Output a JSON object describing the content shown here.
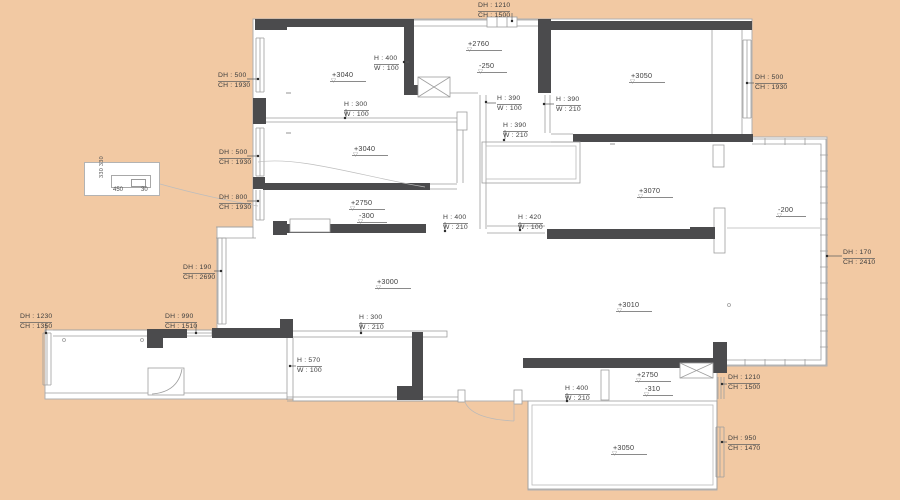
{
  "colors": {
    "background": "#f2c9a3",
    "floor": "#ffffff",
    "wall": "#4b4b4d",
    "line": "#9e9e9e",
    "thin": "#b9b9b9",
    "text": "#3e3e3e",
    "leader": "#5f5f5f"
  },
  "icons": {
    "level_triangle": "▽"
  },
  "dims": [
    {
      "l1": "DH : 500",
      "l2": "CH : 1930"
    },
    {
      "l1": "DH : 500",
      "l2": "CH : 1930"
    },
    {
      "l1": "DH : 800",
      "l2": "CH : 1930"
    },
    {
      "l1": "DH : 190",
      "l2": "CH : 2690"
    },
    {
      "l1": "DH : 1230",
      "l2": "CH : 1350"
    },
    {
      "l1": "DH : 990",
      "l2": "CH : 1510"
    },
    {
      "l1": "DH : 1210",
      "l2": "CH : 1500"
    },
    {
      "l1": "DH : 500",
      "l2": "CH : 1930"
    },
    {
      "l1": "DH : 170",
      "l2": "CH : 2410"
    },
    {
      "l1": "DH : 1210",
      "l2": "CH : 1500"
    },
    {
      "l1": "DH : 950",
      "l2": "CH : 1470"
    }
  ],
  "hw": [
    {
      "l1": "H : 400",
      "l2": "W : 100"
    },
    {
      "l1": "H : 300",
      "l2": "W : 100"
    },
    {
      "l1": "H : 390",
      "l2": "W : 100"
    },
    {
      "l1": "H : 390",
      "l2": "W : 210"
    },
    {
      "l1": "H : 390",
      "l2": "W : 210"
    },
    {
      "l1": "H : 400",
      "l2": "W : 210"
    },
    {
      "l1": "H : 420",
      "l2": "W : 100"
    },
    {
      "l1": "H : 300",
      "l2": "W : 210"
    },
    {
      "l1": "H : 570",
      "l2": "W : 100"
    },
    {
      "l1": "H : 400",
      "l2": "W : 210"
    }
  ],
  "elevations": [
    {
      "t": "+3040"
    },
    {
      "t": "+2760"
    },
    {
      "t": "-250"
    },
    {
      "t": "+3050"
    },
    {
      "t": "+3040"
    },
    {
      "t": "+3070"
    },
    {
      "t": "-200"
    },
    {
      "t": "+2750"
    },
    {
      "t": "-300"
    },
    {
      "t": "+3000"
    },
    {
      "t": "+3010"
    },
    {
      "t": "+2750"
    },
    {
      "t": "-310"
    },
    {
      "t": "+3050"
    }
  ],
  "detail_box": {
    "side": "330 330",
    "bottom_left": "450",
    "bottom_right": "30"
  }
}
